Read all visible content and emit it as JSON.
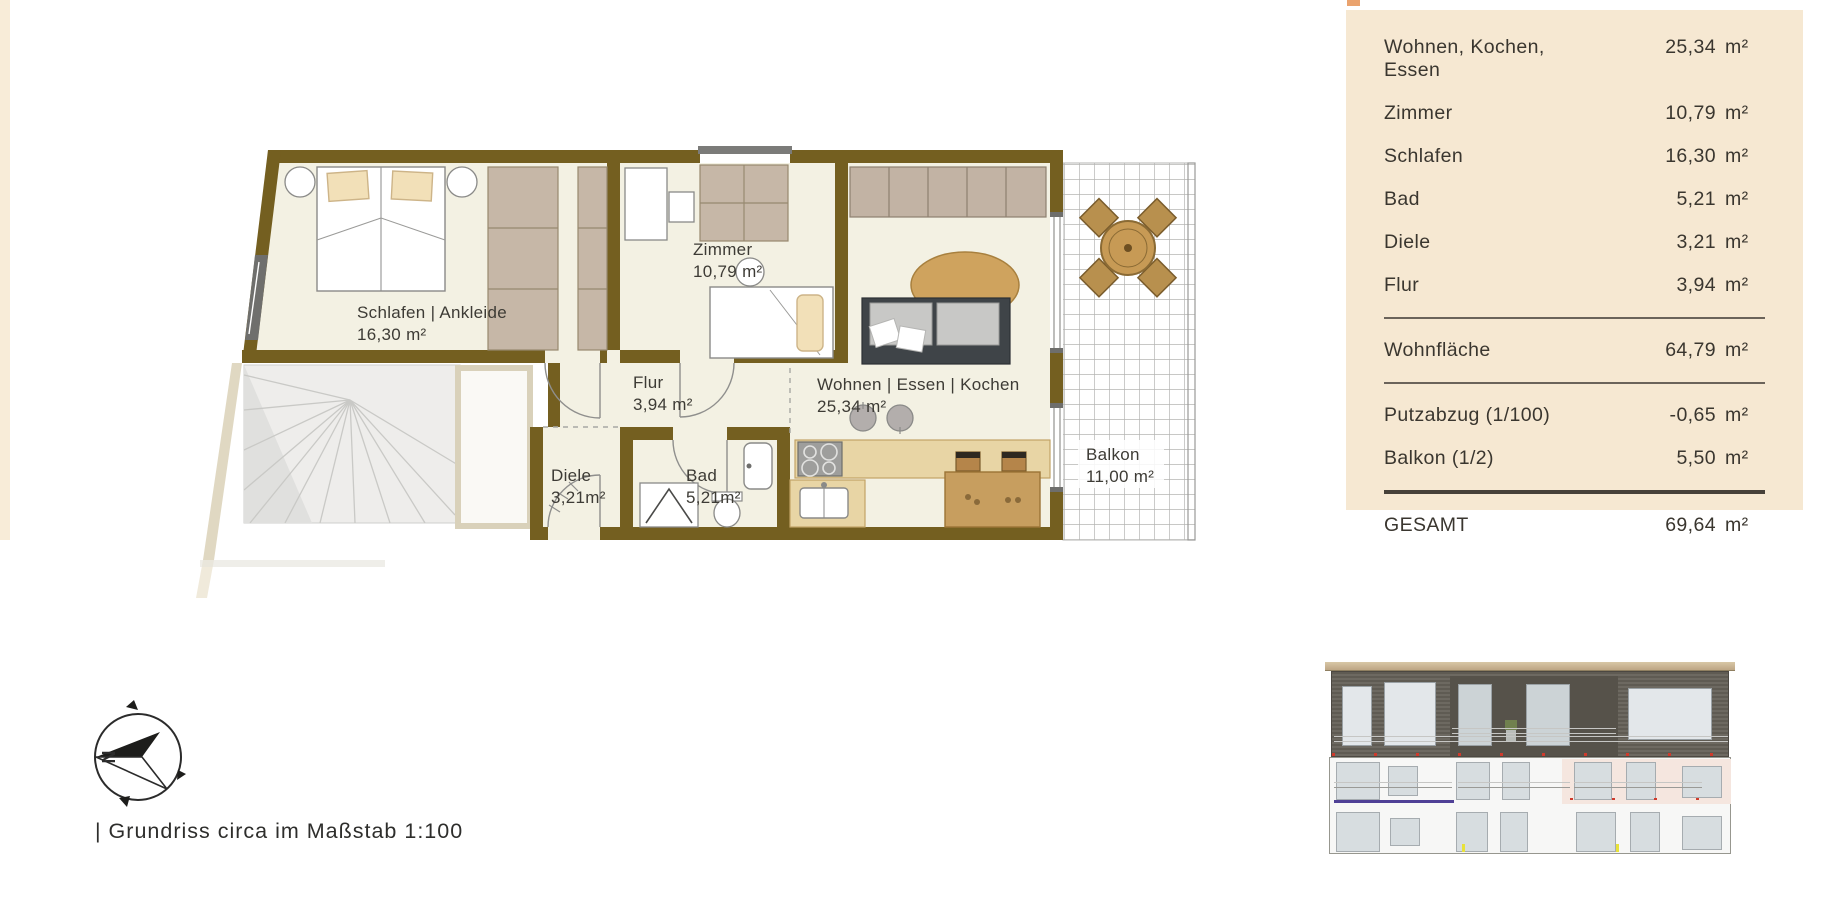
{
  "plan": {
    "rooms": {
      "schlafen": {
        "name": "Schlafen | Ankleide",
        "area": "16,30 m²"
      },
      "zimmer": {
        "name": "Zimmer",
        "area": "10,79 m²"
      },
      "flur": {
        "name": "Flur",
        "area": "3,94 m²"
      },
      "diele": {
        "name": "Diele",
        "area": "3,21m²"
      },
      "bad": {
        "name": "Bad",
        "area": "5,21m²"
      },
      "wohnen": {
        "name": "Wohnen | Essen | Kochen",
        "area": "25,34 m²"
      },
      "balkon": {
        "name": "Balkon",
        "area": "11,00 m²"
      }
    },
    "compass_label": "N",
    "caption": "| Grundriss circa im Maßstab 1:100"
  },
  "area_table": {
    "unit": "m²",
    "rows": [
      {
        "label": "Wohnen, Kochen,",
        "label2": "Essen",
        "value": "25,34"
      },
      {
        "label": "Zimmer",
        "value": "10,79"
      },
      {
        "label": "Schlafen",
        "value": "16,30"
      },
      {
        "label": "Bad",
        "value": "5,21"
      },
      {
        "label": "Diele",
        "value": "3,21"
      },
      {
        "label": "Flur",
        "value": "3,94"
      },
      {
        "label": "Wohnfläche",
        "value": "64,79"
      },
      {
        "label": "Putzabzug (1/100)",
        "value": "-0,65"
      },
      {
        "label": "Balkon (1/2)",
        "value": "5,50"
      },
      {
        "label": "GESAMT",
        "value": "69,64"
      }
    ]
  },
  "colors": {
    "wall": "#745f20",
    "floor": "#f3f1e3",
    "panel_background": "#f6e8d2",
    "closet": "#c6b7a7",
    "wood": "#cda15c",
    "sofa": "#3f4448",
    "highlight_pink": "#f5e6df",
    "red_marker": "#cf3a2c",
    "accent_orange": "#eaa36e"
  }
}
